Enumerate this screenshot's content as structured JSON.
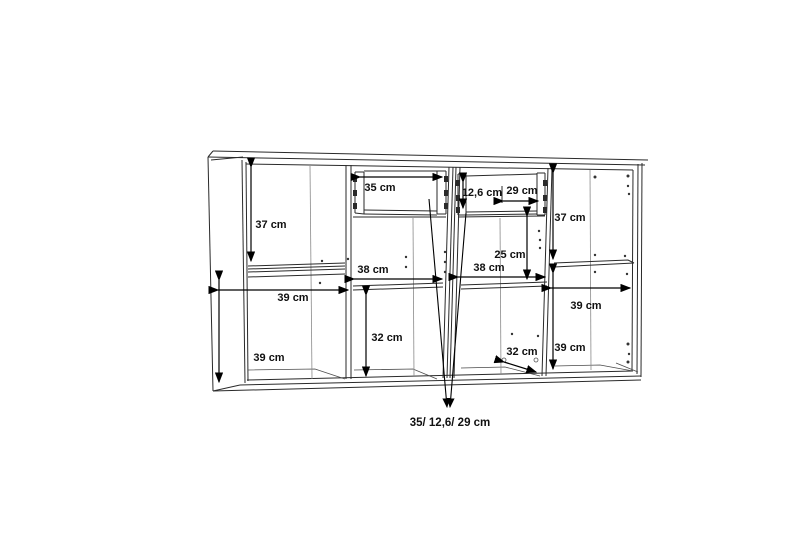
{
  "diagram": {
    "type": "furniture-dimension-line-drawing",
    "subject": "sideboard with four sections, two drawers, shelves",
    "unit": "cm",
    "line_color": "#222222",
    "background": "#ffffff"
  },
  "dims": {
    "left_top_height": "37 cm",
    "left_shelf_width": "39 cm",
    "left_bottom_height": "39 cm",
    "drawer_left_width": "35 cm",
    "drawer_right_height": "12,6 cm",
    "drawer_right_width": "29 cm",
    "mid_left_width": "38 cm",
    "mid_left_bottom_height": "32 cm",
    "mid_right_width": "38 cm",
    "mid_right_mid_height": "25 cm",
    "mid_right_bottom_depth": "32 cm",
    "right_top_height": "37 cm",
    "right_shelf_width": "39 cm",
    "right_bottom_height": "39 cm",
    "drawers_note": "35/ 12,6/ 29 cm"
  }
}
